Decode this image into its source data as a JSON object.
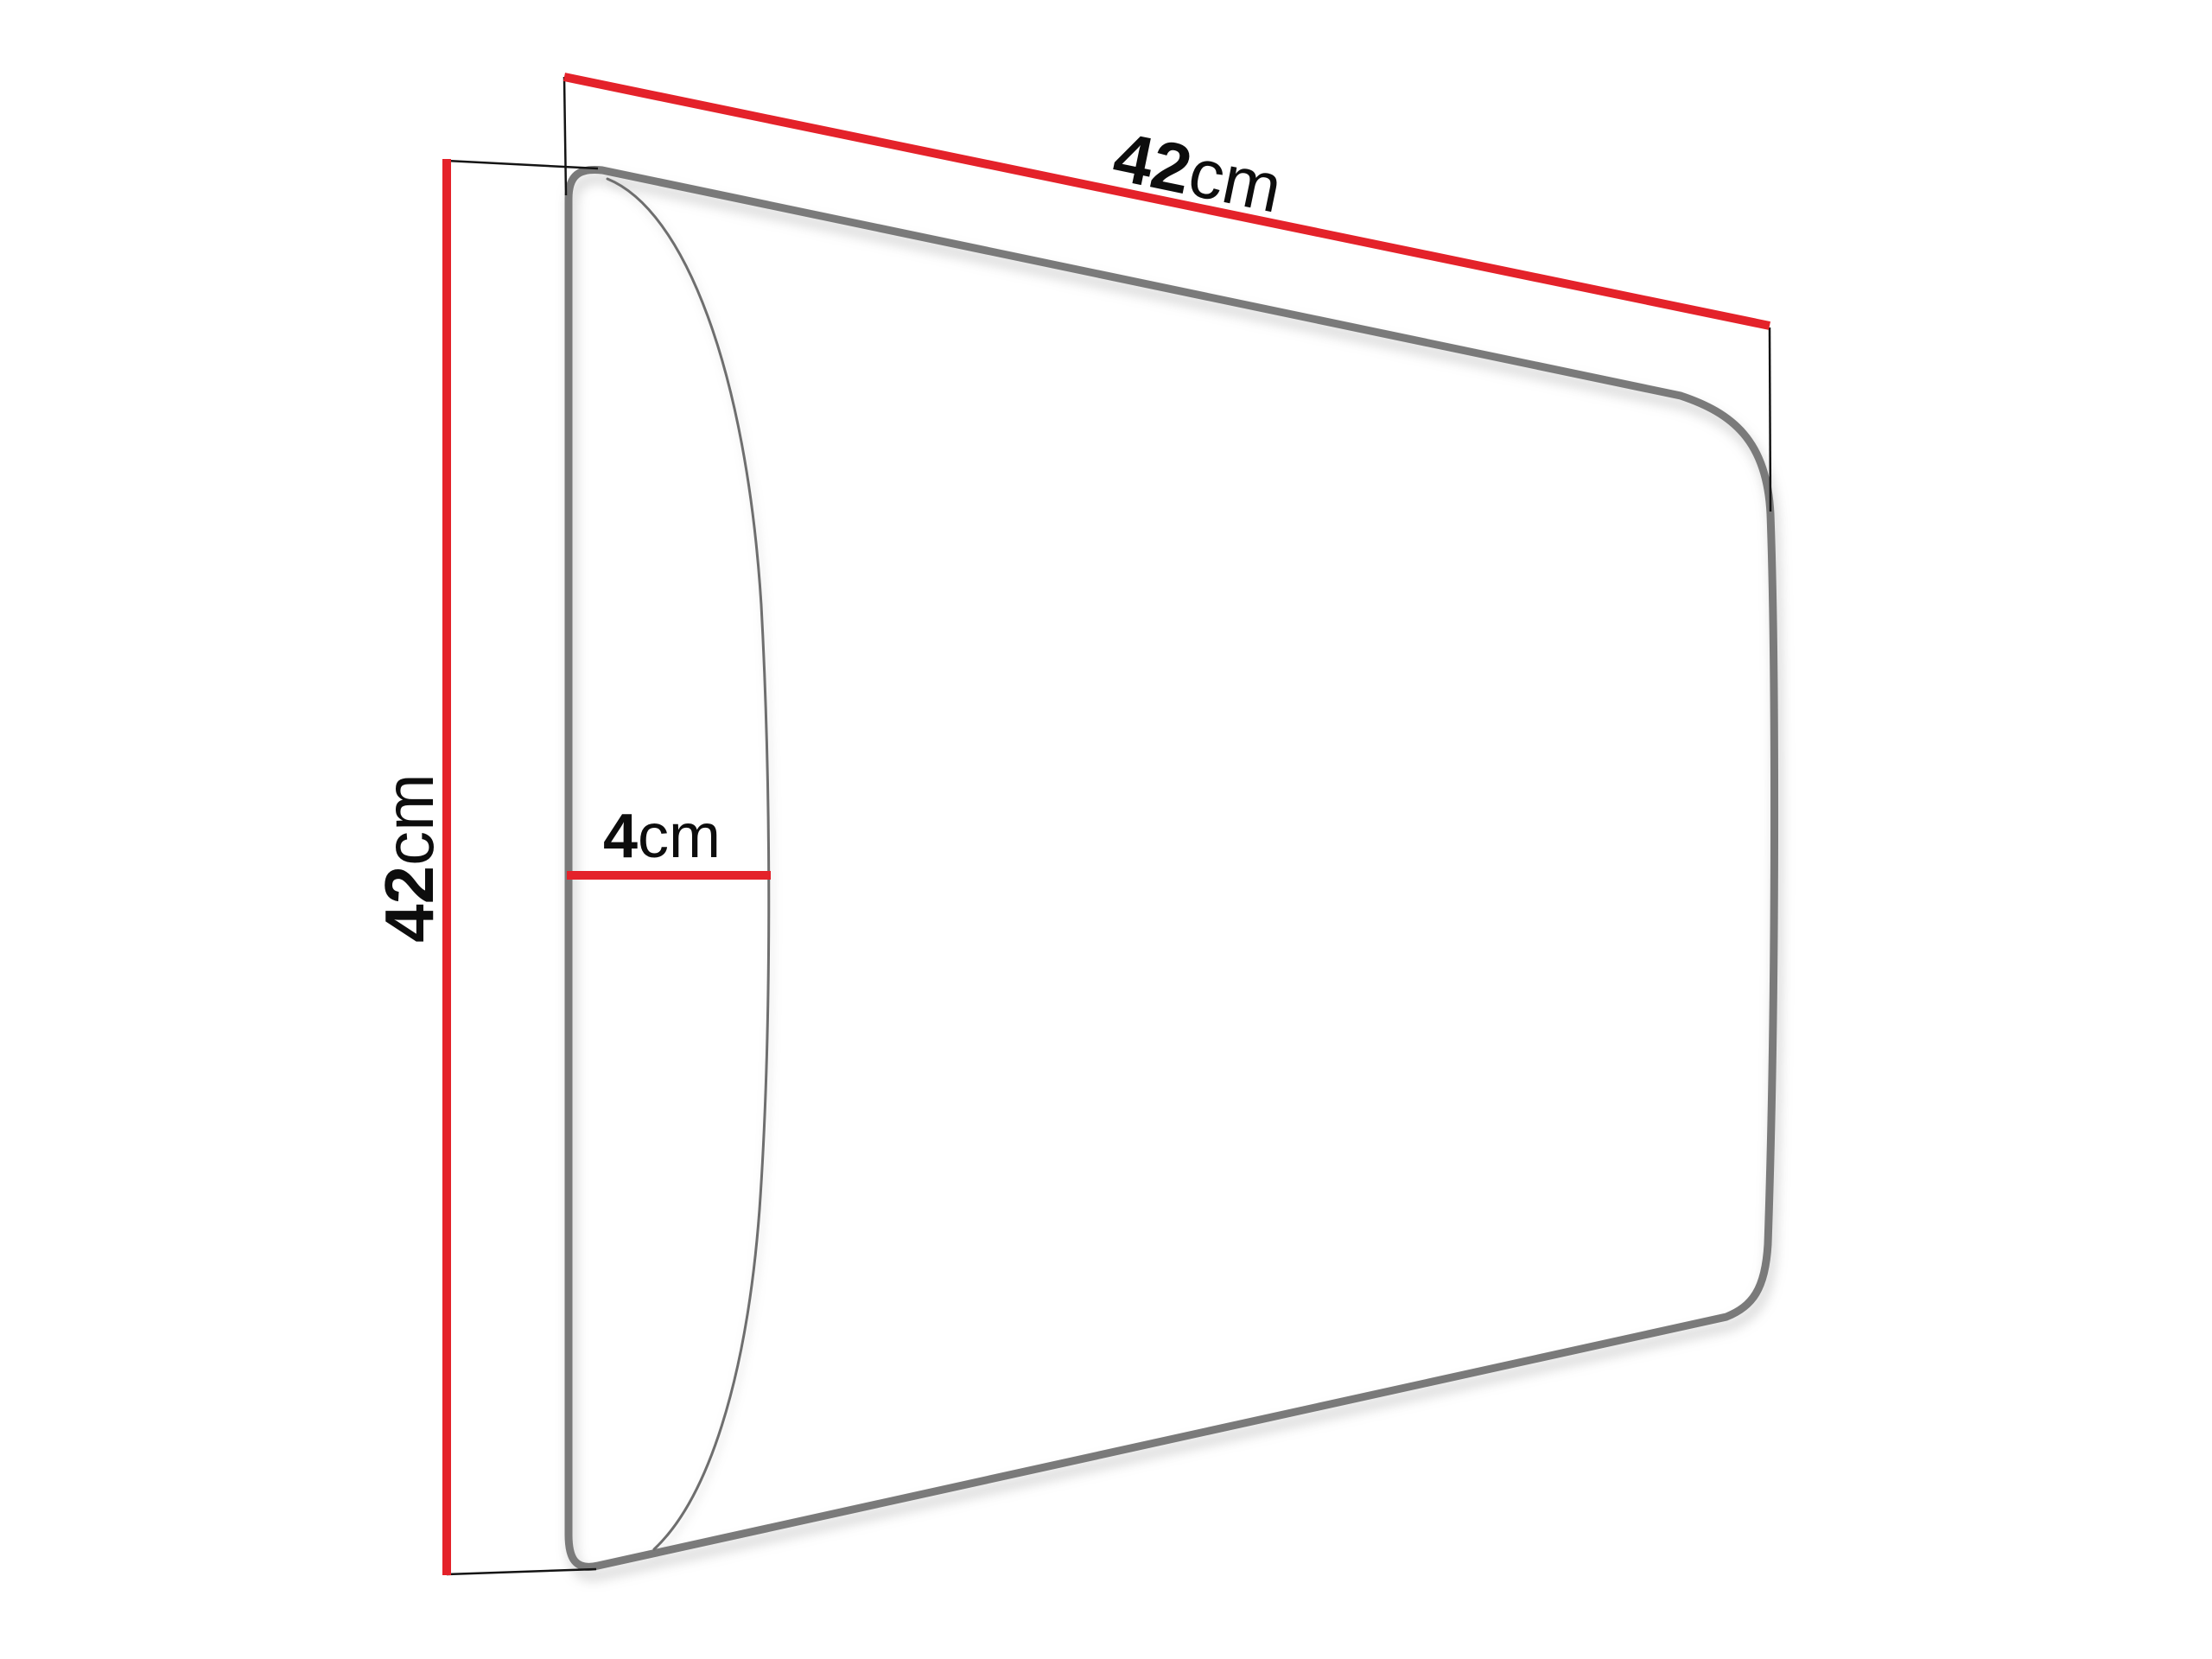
{
  "diagram": {
    "title": "Panel dimension diagram",
    "product": {
      "shape": "rounded rectangular upholstered wall panel shown in perspective with side bulge profile"
    },
    "labels": {
      "width": {
        "value": "42",
        "unit": "cm"
      },
      "height": {
        "value": "42",
        "unit": "cm"
      },
      "depth": {
        "value": "4",
        "unit": "cm"
      }
    },
    "colors": {
      "dimension_line": "#e4222a",
      "panel_edge": "#7a7a7a",
      "panel_detail_line": "#6e6e6e",
      "extension_line": "#141414",
      "label_text": "#0d0d0d",
      "background": "#ffffff"
    }
  }
}
